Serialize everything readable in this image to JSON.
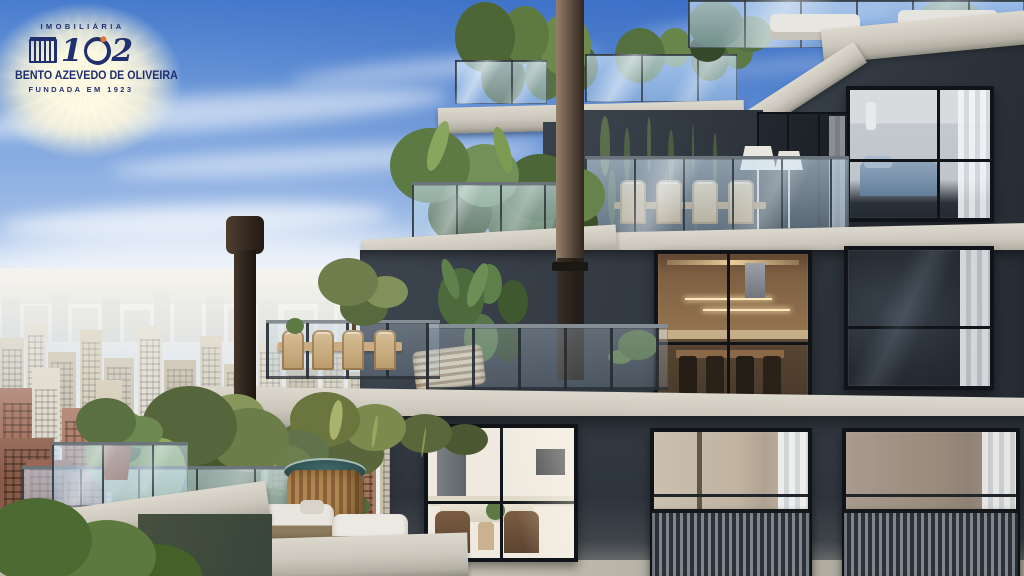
{
  "logo": {
    "brand_top": "IMOBILIÁRIA",
    "brand_number": "102",
    "num_left": "1",
    "num_right": "2",
    "brand_name": "BENTO AZEVEDO DE OLIVEIRA",
    "brand_tagline": "FUNDADA EM 1923"
  },
  "colors": {
    "sky_top": "#4a7ecf",
    "sky_mid": "#9ab9e6",
    "sky_horizon": "#f0f3f4",
    "facade_light": "#3f4750",
    "facade_mid": "#343b43",
    "facade_dark": "#262c34",
    "slab": "#cbc7bc",
    "slab_shadow": "#908d82",
    "frame": "#101418",
    "chimney_bronze": "#7c6753",
    "chimney_dark": "#241e18",
    "foliage_dark": "#42552e",
    "foliage_mid": "#5d7a44",
    "foliage_light": "#7d9355",
    "brick": "#9b6453",
    "city_cream": "#d5cab5",
    "water_teal": "#2f4d4e",
    "wood_warm": "#8a6845",
    "cushion_white": "#e9e6df",
    "logo_navy": "#20306f",
    "logo_glow": "#fdf6da",
    "logo_accent": "#e2762d"
  }
}
